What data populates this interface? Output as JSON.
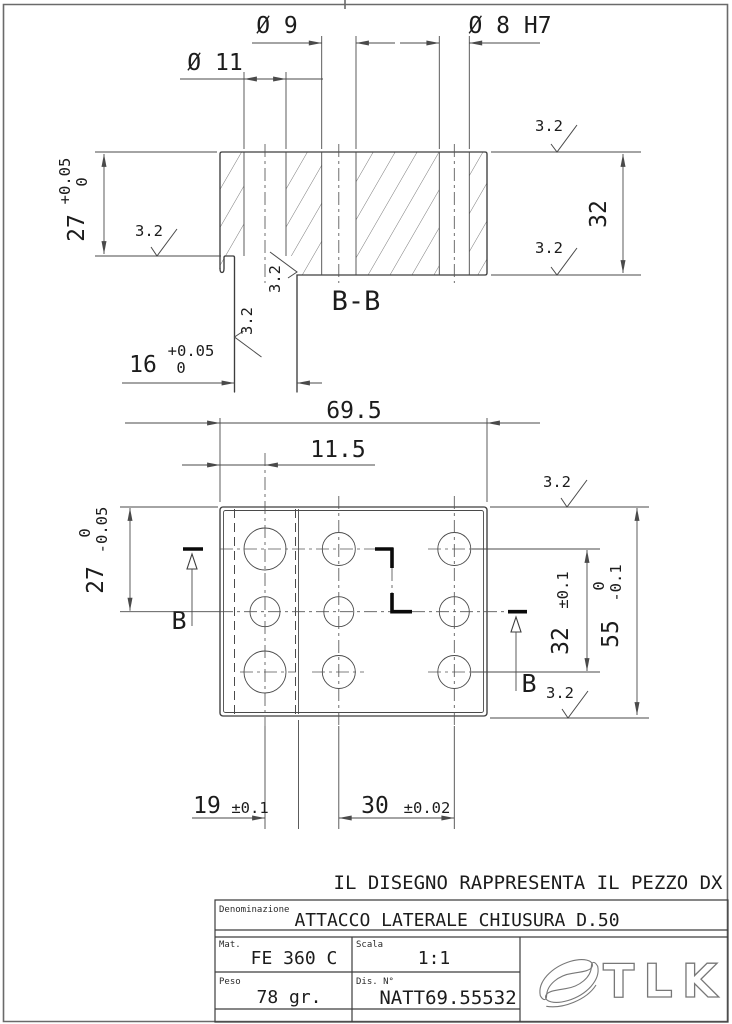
{
  "drawing": {
    "note": "IL DISEGNO RAPPRESENTA IL PEZZO DX",
    "section": {
      "label": "B-B",
      "dia9": "Ø 9",
      "dia11": "Ø 11",
      "dia8": "Ø 8 H7",
      "h27": "27",
      "h27_tol_up": "+0.05",
      "h27_tol_low": "0",
      "h32": "32",
      "w16": "16",
      "w16_tol_up": "+0.05",
      "w16_tol_low": "0",
      "finish": "3.2"
    },
    "plan": {
      "cut_label": "B",
      "w695": "69.5",
      "w115": "11.5",
      "h27": "27",
      "h27_tol_up": "0",
      "h27_tol_low": "-0.05",
      "p32": "32",
      "p32_tol": "±0.1",
      "h55": "55",
      "h55_tol_up": "0",
      "h55_tol_low": "-0.1",
      "s19": "19",
      "s19_tol": "±0.1",
      "s30": "30",
      "s30_tol": "±0.02",
      "finish": "3.2"
    },
    "title_block": {
      "denominazione_label": "Denominazione",
      "denominazione": "ATTACCO LATERALE CHIUSURA D.50",
      "mat_label": "Mat.",
      "mat": "FE 360 C",
      "scala_label": "Scala",
      "scala": "1:1",
      "peso_label": "Peso",
      "peso": "78 gr.",
      "dis_label": "Dis. N°",
      "dis": "NATT69.55532",
      "logo": "TLK"
    }
  }
}
